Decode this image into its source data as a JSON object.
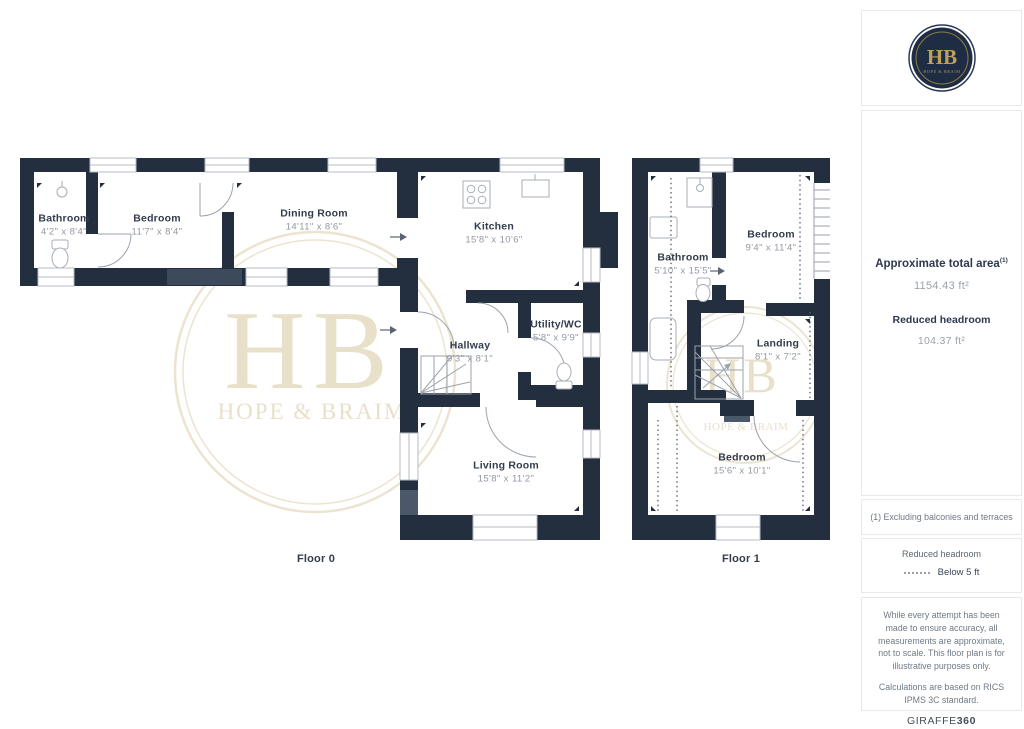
{
  "brand": {
    "logo_monogram": "HB",
    "logo_name": "HOPE & BRAIM",
    "watermark_monogram": "HB",
    "watermark_name": "HOPE & BRAIM",
    "navy": "#232f3f",
    "gold": "#bda05a",
    "watermark_color": "#e9e0ca"
  },
  "floor0": {
    "label": "Floor 0",
    "rooms": [
      {
        "name": "Bathroom",
        "dims": "4'2\" x 8'4\""
      },
      {
        "name": "Bedroom",
        "dims": "11'7\" x 8'4\""
      },
      {
        "name": "Dining Room",
        "dims": "14'11\" x 8'6\""
      },
      {
        "name": "Kitchen",
        "dims": "15'8\" x 10'6\""
      },
      {
        "name": "Utility/WC",
        "dims": "5'8\" x 9'9\""
      },
      {
        "name": "Hallway",
        "dims": "9'3\" x 8'1\""
      },
      {
        "name": "Living Room",
        "dims": "15'8\" x 11'2\""
      }
    ]
  },
  "floor1": {
    "label": "Floor 1",
    "rooms": [
      {
        "name": "Bathroom",
        "dims": "5'10\" x 15'5\""
      },
      {
        "name": "Bedroom",
        "dims": "9'4\" x 11'4\""
      },
      {
        "name": "Landing",
        "dims": "8'1\" x 7'2\""
      },
      {
        "name": "Bedroom",
        "dims": "15'6\" x 10'1\""
      }
    ]
  },
  "sidebar": {
    "total_area_label": "Approximate total area",
    "total_area_footnote_marker": "(1)",
    "total_area_value": "1154.43 ft²",
    "reduced_headroom_label": "Reduced headroom",
    "reduced_headroom_value": "104.37 ft²",
    "footnote": "(1) Excluding balconies and terraces",
    "legend_title": "Reduced headroom",
    "legend_item": "Below 5 ft",
    "disclaimer_1": "While every attempt has been made to ensure accuracy, all measurements are approximate, not to scale. This floor plan is for illustrative purposes only.",
    "disclaimer_2": "Calculations are based on RICS IPMS 3C standard.",
    "brand_footer_name": "GIRAFFE",
    "brand_footer_suffix": "360"
  }
}
